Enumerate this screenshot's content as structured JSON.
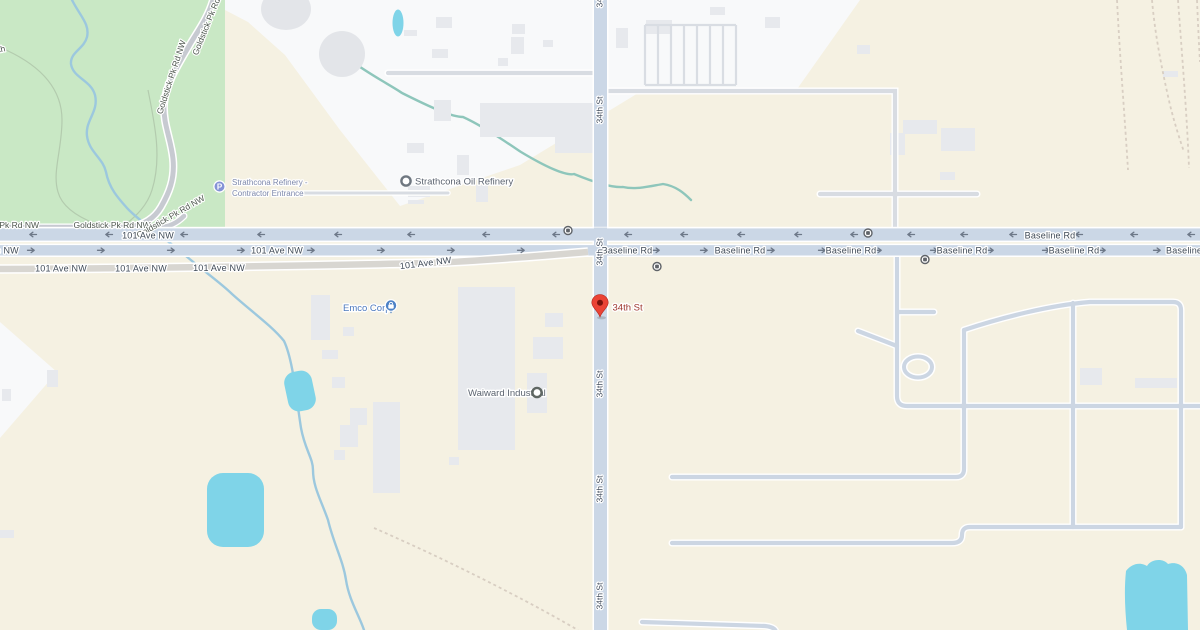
{
  "canvas": {
    "width": 1200,
    "height": 630
  },
  "colors": {
    "land": "#f5f1e2",
    "industrial_land": "#f8f9fa",
    "park": "#c9e8c5",
    "water": "#7fd4e8",
    "stream": "#9cc8de",
    "stream_teal": "#8ec6bb",
    "building": "#e7e9ed",
    "road_major_fill": "#cbd7e6",
    "road_minor_fill": "#ccd6e3",
    "road_old_fill": "#d8d6d1",
    "park_road_fill": "#c7cad1",
    "road_casing": "#ffffff",
    "railway": "#d8cec2",
    "trail": "#b3cbae",
    "arrow": "#6d7888",
    "road_label": "#3f4a57",
    "poi_label_gray": "#5c6470",
    "poi_label_blue": "#4c79bd",
    "parking_label": "#7d88ab",
    "pin_label": "#9d352c",
    "pin_body": "#ea4335",
    "parking_icon_bg": "#8593d6",
    "transit_icon": "#5f6368"
  },
  "roads": {
    "r34": "34th St",
    "baseline": "Baseline Rd",
    "ave101": "101 Ave NW",
    "goldstick": "Goldstick Pk Rd NW",
    "park_label_partial": "ch",
    "band1_direction": "west",
    "band2_direction": "east",
    "band1_arrows_x": [
      32,
      108,
      183,
      260,
      337,
      410,
      485,
      555,
      627,
      683,
      740,
      797,
      853,
      910,
      963,
      1012,
      1078,
      1133,
      1190
    ],
    "band2_arrows_x": [
      32,
      102,
      172,
      242,
      312,
      382,
      452,
      522,
      657,
      705,
      772,
      823,
      879,
      935,
      991,
      1047,
      1103,
      1158
    ]
  },
  "pois": {
    "parking": {
      "line1": "Strathcona Refinery -",
      "line2": "Contractor Entrance",
      "icon": "parking-icon"
    },
    "oil_refinery": {
      "label": "Strathcona Oil Refinery",
      "icon": "poi-ring-icon"
    },
    "emco": {
      "label": "Emco Corp",
      "icon": "shopping-poi-icon"
    },
    "waiward": {
      "label": "Waiward Industrial",
      "icon": "poi-ring-icon"
    }
  },
  "pin": {
    "label": "34th St",
    "icon": "red-map-pin-icon"
  },
  "icons": {
    "parking_letter": "P"
  }
}
